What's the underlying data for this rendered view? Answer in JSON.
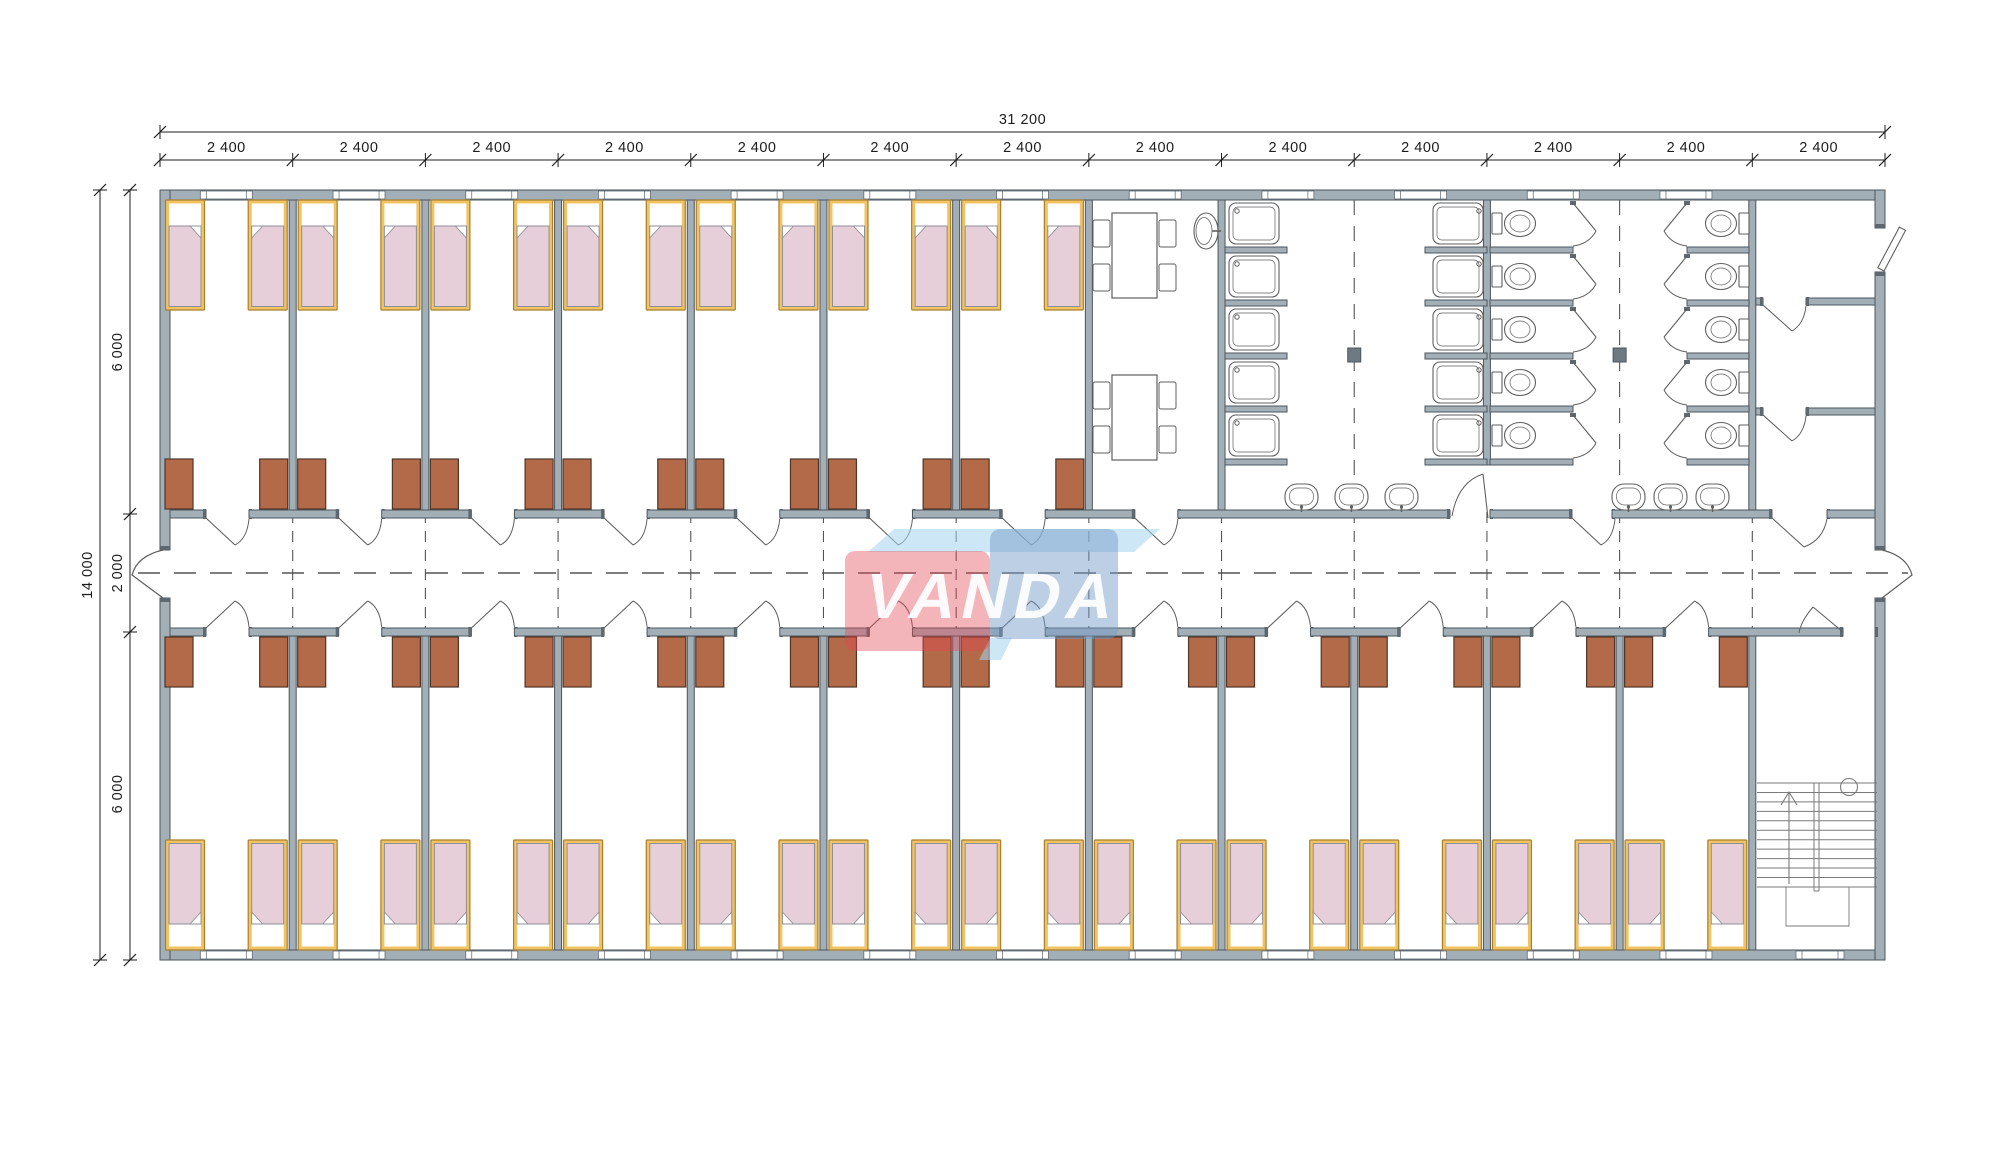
{
  "dimensions": {
    "top_total": "31 200",
    "top_segment_label": "2 400",
    "top_segment_count": 13,
    "left_total": "14 000",
    "left_segment_labels": [
      "6 000",
      "2 000",
      "6 000"
    ]
  },
  "watermark": {
    "text": "VANDA",
    "red": "rgba(228,70,82,0.40)",
    "blue": "rgba(118,155,198,0.48)",
    "light": "rgba(164,212,240,0.55)",
    "text_color": "#ffffff"
  },
  "palette": {
    "wall_fill": "#a3afb7",
    "wall_stroke": "#4b555c",
    "wall_cap": "#5d686f",
    "bed_frame": "#f0c465",
    "bed_frame_stroke": "#a97f2c",
    "bed_sheet": "#ffffff",
    "bed_blanket": "#e6cfd8",
    "bed_blanket_stroke": "#8e8e98",
    "wardrobe_fill": "#b26a49",
    "wardrobe_stroke": "#4f3627",
    "fixture_stroke": "#5f5f5f",
    "stair_stroke": "#7a7a7a",
    "dash_color": "#555555",
    "dim_color": "#1d1d1d",
    "column_fill": "#6e7a81"
  },
  "inventory": {
    "bedroom_modules_top": 7,
    "bedroom_modules_bottom": 12,
    "beds": 38,
    "wardrobes": 38,
    "showers": 10,
    "toilets": 10,
    "wash_basins": 6,
    "canteen_tables": 2,
    "chairs_per_table": 4,
    "stair_flights": 2
  }
}
